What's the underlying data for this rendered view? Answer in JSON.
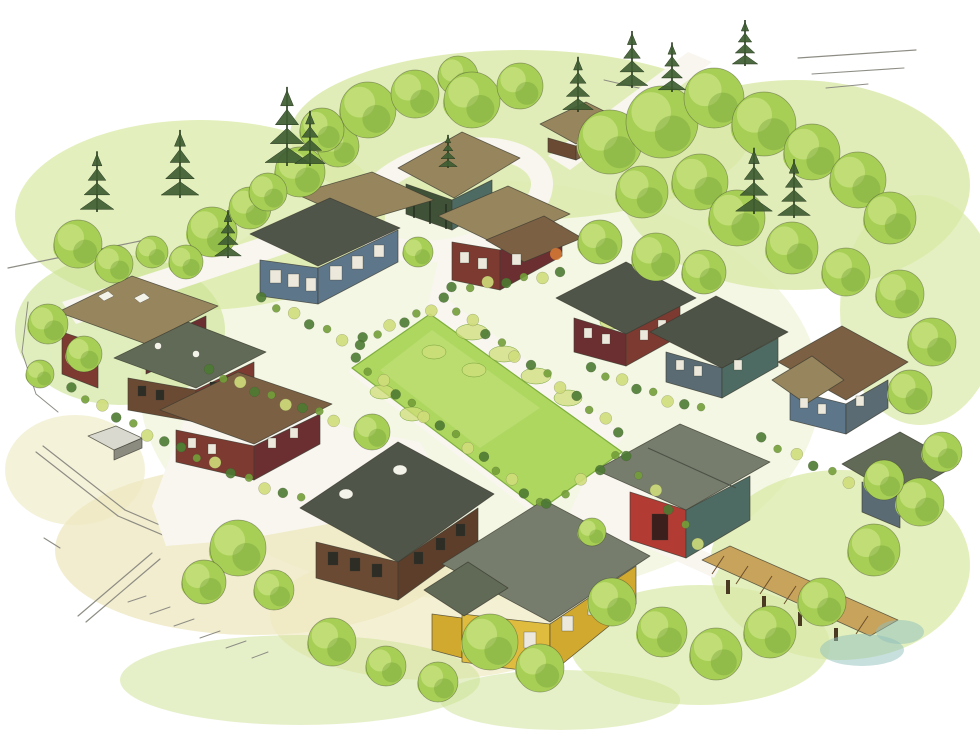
{
  "image": {
    "width": 980,
    "height": 736,
    "kind": "watercolor-aerial-site-illustration"
  },
  "palette": {
    "paper": "#ffffff",
    "wash_green": "#d9e9a6",
    "wash_green2": "#cce293",
    "wash_base": "#e9f1cc",
    "wash_yellow": "#efe9c2",
    "lawn": "#aed75f",
    "lawn_light": "#c8e381",
    "lawn_edge": "#7fae3f",
    "tree": "#a7cf55",
    "tree_light": "#c6e07c",
    "tree_dark": "#739f39",
    "pine": "#3f5d32",
    "pine_dark": "#27391f",
    "shrub_dark": "#4d7a32",
    "shrub_yellow": "#cfdd7a",
    "path": "#f8f6ef",
    "path_edge": "#c7c2af",
    "road_line": "#8e8d85",
    "outline": "#3b3b30",
    "roof_dark": "#50554a",
    "roof_gray": "#767d6c",
    "roof_gray2": "#616a56",
    "roof_green": "#4d5347",
    "roof_tan": "#97855d",
    "roof_brown": "#7c6044",
    "wall_red": "#7d3a31",
    "wall_maroon": "#6c2f31",
    "wall_bright_red": "#b23b34",
    "wall_blue": "#5e7689",
    "wall_slate": "#5a6b73",
    "wall_teal": "#4e6b63",
    "wall_brown": "#6b4a33",
    "wall_brown2": "#5d3e2b",
    "wall_yellow": "#dfbc3e",
    "wall_yellow_shade": "#d2a92f",
    "pavilion_dark": "#3f5238",
    "pergola": "#c8a35c",
    "pergola_dark": "#4a3a22",
    "skylight": "#f3f3ea",
    "window_light": "#ece9dc",
    "window_dark": "#2d2d26",
    "accent_orange": "#d97b35",
    "water": "#8fc0bc",
    "shed_light": "#d9d9cf",
    "shed_shadow": "#8b8b80",
    "door_dark": "#3a1f1c"
  },
  "objects": {
    "buildings": [
      "common-house-pavilion",
      "entry-cottage",
      "blue-house",
      "center-red-house",
      "maroon-house",
      "slate-house",
      "hip-roof-blue-house",
      "taupe-roof-red-house",
      "gray-roof-house",
      "brown-roof-red-house",
      "south-brown-house",
      "yellow-house",
      "red-garage",
      "right-edge-house",
      "pergola-trellis",
      "garden-shed"
    ],
    "landscape": [
      "central-green-lawn",
      "looped-entry-drive",
      "white-garden-paths",
      "street-lines",
      "vegetable-patches",
      "deciduous-trees",
      "evergreen-pines",
      "shrub-borders",
      "watercolor-washes",
      "pond-wash"
    ]
  },
  "scene": {
    "trees": [
      [
        78,
        244,
        24
      ],
      [
        114,
        264,
        19
      ],
      [
        152,
        252,
        16
      ],
      [
        212,
        232,
        25
      ],
      [
        250,
        208,
        21
      ],
      [
        186,
        262,
        17
      ],
      [
        300,
        172,
        25
      ],
      [
        338,
        146,
        21
      ],
      [
        268,
        192,
        19
      ],
      [
        368,
        110,
        28
      ],
      [
        322,
        130,
        22
      ],
      [
        415,
        94,
        24
      ],
      [
        458,
        76,
        20
      ],
      [
        472,
        100,
        28
      ],
      [
        520,
        86,
        23
      ],
      [
        610,
        142,
        32
      ],
      [
        662,
        122,
        36
      ],
      [
        714,
        98,
        30
      ],
      [
        764,
        124,
        32
      ],
      [
        812,
        152,
        28
      ],
      [
        858,
        180,
        28
      ],
      [
        890,
        218,
        26
      ],
      [
        700,
        182,
        28
      ],
      [
        642,
        192,
        26
      ],
      [
        737,
        218,
        28
      ],
      [
        792,
        248,
        26
      ],
      [
        846,
        272,
        24
      ],
      [
        900,
        294,
        24
      ],
      [
        932,
        342,
        24
      ],
      [
        910,
        392,
        22
      ],
      [
        600,
        242,
        22
      ],
      [
        656,
        257,
        24
      ],
      [
        704,
        272,
        22
      ],
      [
        48,
        324,
        20
      ],
      [
        84,
        354,
        18
      ],
      [
        40,
        374,
        14
      ],
      [
        418,
        252,
        15
      ],
      [
        372,
        432,
        18
      ],
      [
        238,
        548,
        28
      ],
      [
        204,
        582,
        22
      ],
      [
        274,
        590,
        20
      ],
      [
        332,
        642,
        24
      ],
      [
        386,
        666,
        20
      ],
      [
        438,
        682,
        20
      ],
      [
        490,
        642,
        28
      ],
      [
        540,
        668,
        24
      ],
      [
        612,
        602,
        24
      ],
      [
        662,
        632,
        25
      ],
      [
        716,
        654,
        26
      ],
      [
        770,
        632,
        26
      ],
      [
        822,
        602,
        24
      ],
      [
        874,
        550,
        26
      ],
      [
        920,
        502,
        24
      ],
      [
        942,
        452,
        20
      ],
      [
        884,
        480,
        20
      ],
      [
        592,
        532,
        14
      ]
    ],
    "pines": [
      [
        97,
        146,
        66
      ],
      [
        180,
        124,
        74
      ],
      [
        287,
        80,
        86
      ],
      [
        310,
        106,
        60
      ],
      [
        228,
        206,
        52
      ],
      [
        578,
        52,
        60
      ],
      [
        632,
        26,
        62
      ],
      [
        672,
        38,
        54
      ],
      [
        745,
        16,
        50
      ],
      [
        754,
        142,
        72
      ],
      [
        794,
        154,
        64
      ],
      [
        448,
        132,
        36
      ]
    ],
    "beds": [
      {
        "from": [
          442,
          300
        ],
        "to": [
          620,
          430
        ],
        "n": 13
      },
      {
        "from": [
          354,
          360
        ],
        "to": [
          540,
          502
        ],
        "n": 14
      },
      {
        "from": [
          364,
          340
        ],
        "to": [
          430,
          308
        ],
        "n": 6
      },
      {
        "from": [
          208,
          372
        ],
        "to": [
          334,
          420
        ],
        "n": 9
      },
      {
        "from": [
          452,
          290
        ],
        "to": [
          560,
          272
        ],
        "n": 7
      },
      {
        "from": [
          624,
          458
        ],
        "to": [
          700,
          542
        ],
        "n": 6
      },
      {
        "from": [
          548,
          506
        ],
        "to": [
          616,
          456
        ],
        "n": 5
      },
      {
        "from": [
          70,
          390
        ],
        "to": [
          180,
          450
        ],
        "n": 8
      },
      {
        "from": [
          180,
          450
        ],
        "to": [
          300,
          500
        ],
        "n": 8
      },
      {
        "from": [
          260,
          300
        ],
        "to": [
          360,
          345
        ],
        "n": 7
      },
      {
        "from": [
          590,
          370
        ],
        "to": [
          700,
          410
        ],
        "n": 8
      },
      {
        "from": [
          760,
          440
        ],
        "to": [
          850,
          480
        ],
        "n": 6
      }
    ],
    "patches": [
      [
        472,
        332,
        16,
        8
      ],
      [
        504,
        354,
        15,
        8
      ],
      [
        536,
        376,
        15,
        8
      ],
      [
        568,
        398,
        14,
        8
      ],
      [
        474,
        370,
        12,
        7
      ],
      [
        434,
        352,
        12,
        7
      ],
      [
        586,
        302,
        13,
        7
      ],
      [
        612,
        322,
        12,
        7
      ],
      [
        382,
        392,
        12,
        7
      ],
      [
        412,
        414,
        12,
        7
      ],
      [
        648,
        476,
        12,
        7
      ]
    ],
    "strokes": [
      [
        8,
        268,
        145,
        240,
        1.2
      ],
      [
        798,
        58,
        916,
        50,
        1.2
      ],
      [
        812,
        74,
        904,
        68,
        1.1
      ],
      [
        826,
        88,
        868,
        84,
        1
      ],
      [
        604,
        80,
        656,
        92,
        1
      ],
      [
        36,
        452,
        118,
        516,
        1.2
      ],
      [
        43,
        446,
        125,
        510,
        1.2
      ],
      [
        118,
        516,
        184,
        544,
        1.2
      ],
      [
        125,
        510,
        190,
        538,
        1.2
      ],
      [
        152,
        553,
        78,
        616,
        1.2
      ],
      [
        160,
        559,
        86,
        622,
        1.2
      ],
      [
        44,
        538,
        60,
        548,
        1.1
      ],
      [
        128,
        602,
        146,
        596,
        1
      ],
      [
        150,
        614,
        170,
        607,
        1
      ],
      [
        174,
        626,
        194,
        619,
        1
      ],
      [
        200,
        638,
        220,
        631,
        1
      ],
      [
        226,
        648,
        246,
        641,
        1
      ],
      [
        252,
        658,
        268,
        652,
        1
      ],
      [
        196,
        516,
        212,
        510,
        1
      ],
      [
        28,
        302,
        22,
        352,
        1
      ],
      [
        22,
        352,
        36,
        394,
        1
      ],
      [
        36,
        394,
        58,
        412,
        1
      ]
    ],
    "water": [
      [
        862,
        650,
        42,
        16
      ],
      [
        900,
        632,
        24,
        12
      ]
    ]
  }
}
